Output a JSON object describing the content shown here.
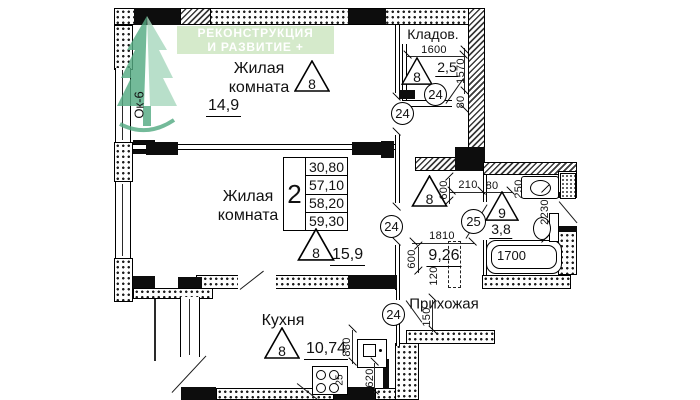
{
  "logo": {
    "line1": "РЕКОНСТРУКЦИЯ",
    "line2": "И РАЗВИТИЕ +"
  },
  "colors": {
    "logo_bg": "#d1e8c7",
    "logo_text": "#ffffff",
    "tree_dark": "#55ab83",
    "tree_light": "#a9d9bf",
    "line": "#111111"
  },
  "rooms": {
    "living1": {
      "name1": "Жилая",
      "name2": "комната",
      "area": "14,9",
      "marker": "8"
    },
    "living2": {
      "name1": "Жилая",
      "name2": "комната",
      "area": "15,9",
      "marker": "8"
    },
    "kitchen": {
      "name": "Кухня",
      "area": "10,74",
      "marker": "8"
    },
    "storage": {
      "name": "Кладов.",
      "area": "2,5",
      "marker": "8"
    },
    "hallway": {
      "name": "Прихожая",
      "area": "9,26",
      "marker": "8"
    },
    "bathroom": {
      "area": "3,8",
      "marker": "9"
    }
  },
  "area_table": {
    "flat_type": "2",
    "rows": [
      "30,80",
      "57,10",
      "58,20",
      "59,30"
    ]
  },
  "labels": {
    "window": "Ок-6"
  },
  "door_marks": {
    "m1": "24",
    "m2": "24",
    "m3": "24",
    "m4": "24",
    "m5": "25"
  },
  "dims": {
    "storage_width": "1600",
    "storage_depth": "1570",
    "storage_jamb": "80",
    "bath_door": "210",
    "bath_jamb": "80",
    "bath_niche": "250",
    "bath_length": "2230",
    "bathtub": "1700",
    "door_top": "600",
    "door_bottom": "600",
    "hall_step": "120",
    "hall_width": "1810",
    "pass": "150",
    "kitchen_d1": "880",
    "kitchen_d2": "620",
    "stove": "25"
  }
}
